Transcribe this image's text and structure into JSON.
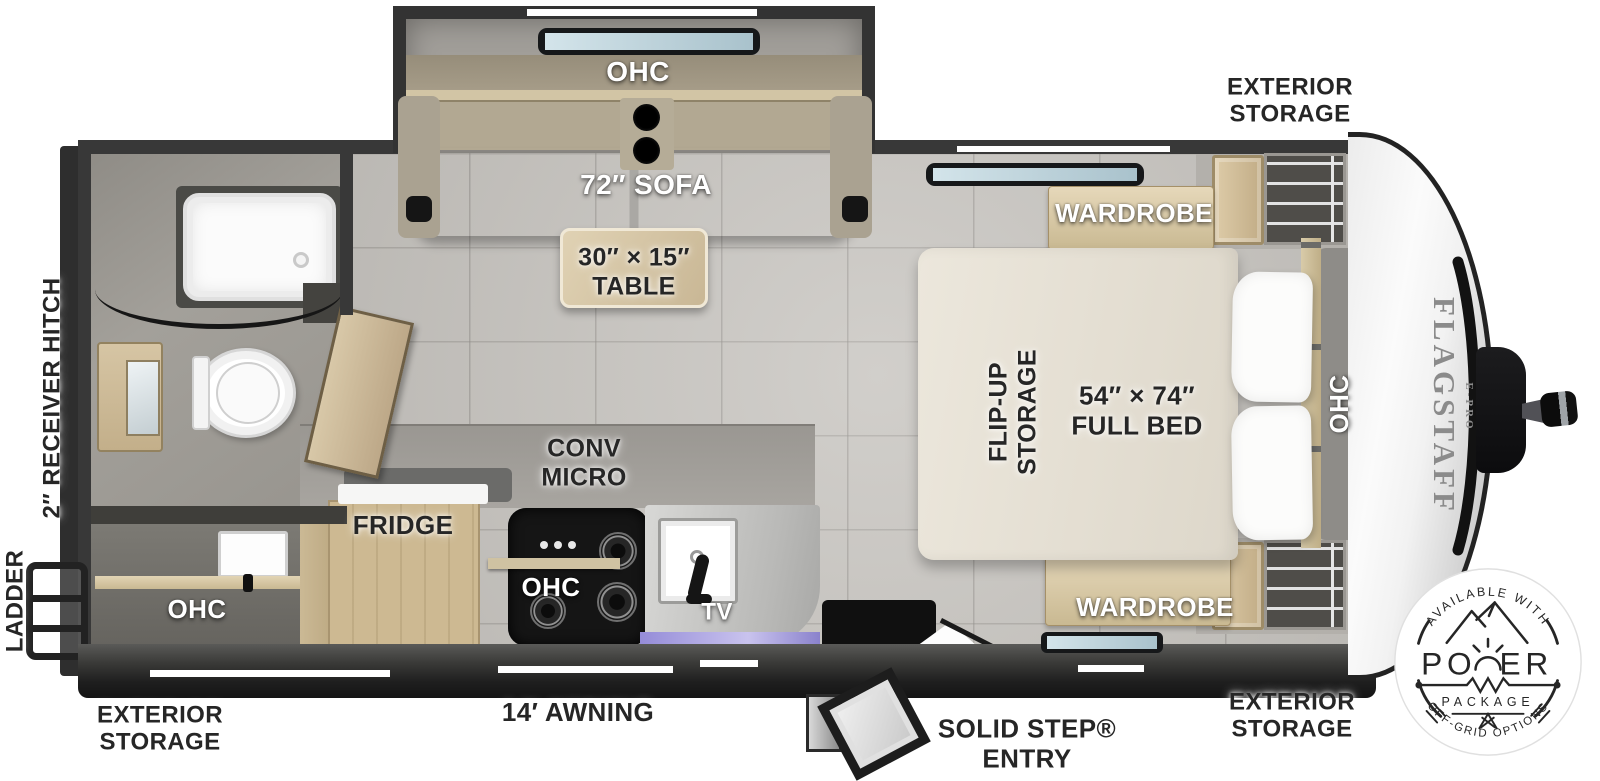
{
  "title": "Flagstaff E-Pro travel trailer floor plan",
  "colors": {
    "wall": "#383838",
    "floor": "#c6c3be",
    "wood": "#d3c2a0",
    "label_dark": "#262626",
    "label_white": "#ffffff",
    "stove": "#151515",
    "glass": "#cfe0e8",
    "led_strip": "#958cd8"
  },
  "labels": {
    "receiver_hitch": "2″ RECEIVER HITCH",
    "ladder": "LADDER",
    "rear_ohc": "OHC",
    "exterior_storage_rear": "EXTERIOR\nSTORAGE",
    "awning": "14′ AWNING",
    "slide_ohc": "OHC",
    "sofa": "72″ SOFA",
    "table": "30″ × 15″\nTABLE",
    "conv_micro": "CONV\nMICRO",
    "fridge": "FRIDGE",
    "kitchen_ohc": "OHC",
    "tv": "TV",
    "entry": "SOLID STEP®\nENTRY",
    "exterior_storage_top": "EXTERIOR\nSTORAGE",
    "wardrobe_top": "WARDROBE",
    "flip_up_storage": "FLIP-UP\nSTORAGE",
    "bed": "54″ × 74″\nFULL BED",
    "bed_ohc": "OHC",
    "wardrobe_bottom": "WARDROBE",
    "exterior_storage_bottom": "EXTERIOR\nSTORAGE"
  },
  "brand": {
    "name": "FLAGSTAFF",
    "sub": "E-PRO"
  },
  "badge": {
    "available": "AVAILABLE WITH",
    "power_left": "PO",
    "power_right": "ER",
    "package": "PACKAGE",
    "offgrid": "OFF-GRID OPTIONS"
  }
}
